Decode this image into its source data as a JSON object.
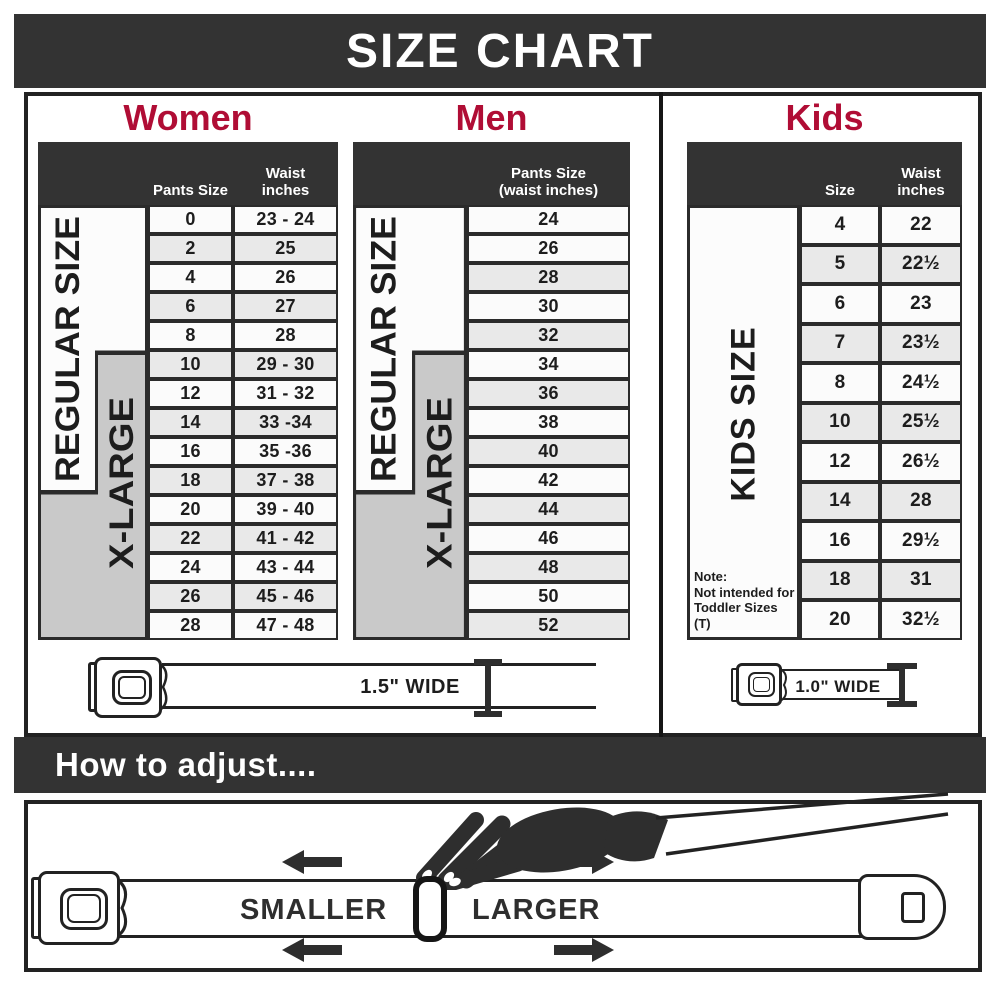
{
  "title": "SIZE CHART",
  "sections": {
    "women": {
      "heading": "Women",
      "columns": {
        "pants": "Pants Size",
        "waist": "Waist\ninches"
      },
      "regular_label": "REGULAR SIZE",
      "xlarge_label": "X-LARGE",
      "rows": [
        {
          "size": "0",
          "waist": "23 - 24"
        },
        {
          "size": "2",
          "waist": "25"
        },
        {
          "size": "4",
          "waist": "26"
        },
        {
          "size": "6",
          "waist": "27"
        },
        {
          "size": "8",
          "waist": "28"
        },
        {
          "size": "10",
          "waist": "29 - 30"
        },
        {
          "size": "12",
          "waist": "31 - 32"
        },
        {
          "size": "14",
          "waist": "33 -34"
        },
        {
          "size": "16",
          "waist": "35 -36"
        },
        {
          "size": "18",
          "waist": "37 - 38"
        },
        {
          "size": "20",
          "waist": "39 - 40"
        },
        {
          "size": "22",
          "waist": "41 - 42"
        },
        {
          "size": "24",
          "waist": "43 - 44"
        },
        {
          "size": "26",
          "waist": "45 - 46"
        },
        {
          "size": "28",
          "waist": "47 - 48"
        }
      ]
    },
    "men": {
      "heading": "Men",
      "column": "Pants Size\n(waist inches)",
      "regular_label": "REGULAR SIZE",
      "xlarge_label": "X-LARGE",
      "rows": [
        "24",
        "26",
        "28",
        "30",
        "32",
        "34",
        "36",
        "38",
        "40",
        "42",
        "44",
        "46",
        "48",
        "50",
        "52"
      ]
    },
    "kids": {
      "heading": "Kids",
      "columns": {
        "size": "Size",
        "waist": "Waist\ninches"
      },
      "side_label": "KIDS SIZE",
      "note": "Note:\nNot intended for\nToddler Sizes (T)",
      "rows": [
        {
          "size": "4",
          "waist": "22"
        },
        {
          "size": "5",
          "waist": "22½"
        },
        {
          "size": "6",
          "waist": "23"
        },
        {
          "size": "7",
          "waist": "23½"
        },
        {
          "size": "8",
          "waist": "24½"
        },
        {
          "size": "10",
          "waist": "25½"
        },
        {
          "size": "12",
          "waist": "26½"
        },
        {
          "size": "14",
          "waist": "28"
        },
        {
          "size": "16",
          "waist": "29½"
        },
        {
          "size": "18",
          "waist": "31"
        },
        {
          "size": "20",
          "waist": "32½"
        }
      ]
    }
  },
  "belts": {
    "adult_label": "1.5\" WIDE",
    "kids_label": "1.0\" WIDE"
  },
  "how_to_adjust": {
    "heading": "How to adjust....",
    "smaller_label": "SMALLER",
    "larger_label": "LARGER"
  },
  "colors": {
    "accent": "#b00d35",
    "banner": "#333333",
    "border": "#2b2b2b",
    "xlarge_fill": "#c9c9c9",
    "row_alt_fill": "#e9e9e9"
  }
}
